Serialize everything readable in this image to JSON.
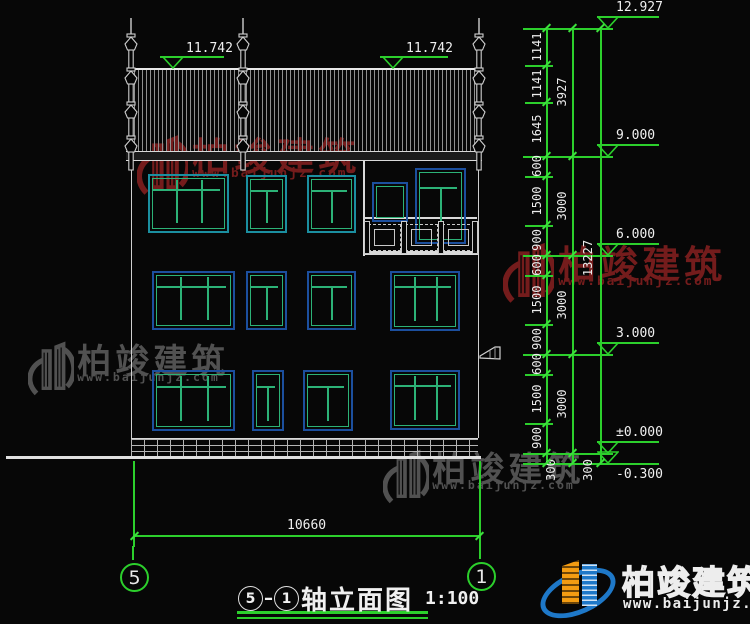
{
  "drawing": {
    "title": {
      "axis_start": "5",
      "axis_end": "1",
      "name": "轴立面图",
      "scale": "1:100"
    },
    "axis_bubbles": [
      {
        "label": "5"
      },
      {
        "label": "1"
      }
    ],
    "roof_elevation_markers": [
      "11.742",
      "11.742"
    ],
    "right_elevation_markers": [
      "12.927",
      "9.000",
      "6.000",
      "3.000",
      "±0.000",
      "-0.300"
    ],
    "dim_chains": {
      "inner": [
        "1141",
        "1141",
        "1645",
        "600",
        "1500",
        "900",
        "600",
        "1500",
        "900",
        "600",
        "1500",
        "900",
        "300"
      ],
      "outer": [
        "3927",
        "3000",
        "3000",
        "3000",
        "300"
      ],
      "total": "13227"
    },
    "bottom_dim": "10660"
  },
  "watermark": {
    "brand": "柏竣建筑",
    "url": "www.baijunjz.com"
  },
  "logo": {
    "brand": "柏竣建筑",
    "url": "www.baijunjz.com"
  },
  "colors": {
    "dim_green": "#2ccf2c",
    "tick_green": "#3ce03c",
    "line_white": "#d9d9d9",
    "frame_teal": "#1b8fa0",
    "frame_blue": "#1c4f9e",
    "mullion_green": "#2cb277",
    "watermark_red": "#7a1e1e",
    "watermark_gray": "#565656",
    "logo_blue": "#1e78c8",
    "logo_orange": "#f39c12"
  }
}
